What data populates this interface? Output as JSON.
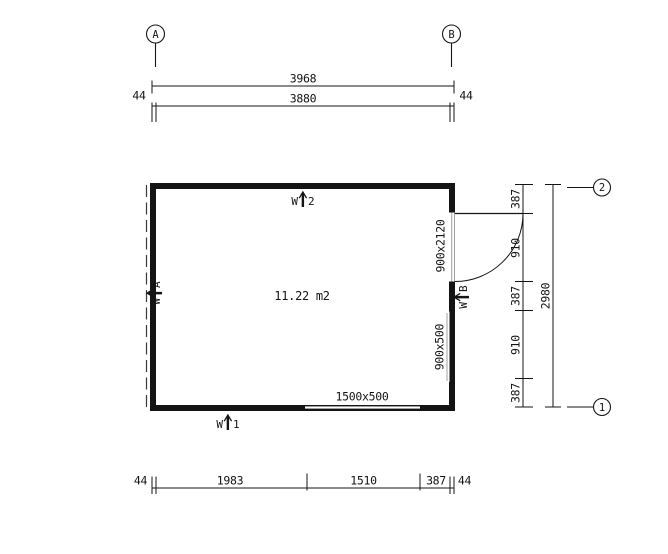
{
  "plan": {
    "area_label": "11.22 m2",
    "door_size_label": "900x2120",
    "window_right_label": "900x500",
    "window_bottom_label": "1500x500",
    "markers": {
      "w1": {
        "prefix": "W",
        "suffix": "1"
      },
      "w2": {
        "prefix": "W",
        "suffix": "2"
      },
      "wa": {
        "prefix": "W",
        "suffix": "A"
      },
      "wb": {
        "prefix": "W",
        "suffix": "B"
      }
    }
  },
  "grid": {
    "axis_a": "A",
    "axis_b": "B",
    "axis_1": "1",
    "axis_2": "2"
  },
  "dimensions": {
    "top": {
      "overall": "3968",
      "inner": "3880",
      "wall_left": "44",
      "wall_right": "44"
    },
    "bottom": {
      "wall_left": "44",
      "segments": [
        "1983",
        "1510",
        "387"
      ],
      "wall_right": "44"
    },
    "right": {
      "segments": [
        "387",
        "910",
        "387",
        "910",
        "387"
      ],
      "overall": "2980"
    }
  },
  "colors": {
    "line": "#141414",
    "background": "#ffffff",
    "frame_gray": "#a0a0a0"
  }
}
